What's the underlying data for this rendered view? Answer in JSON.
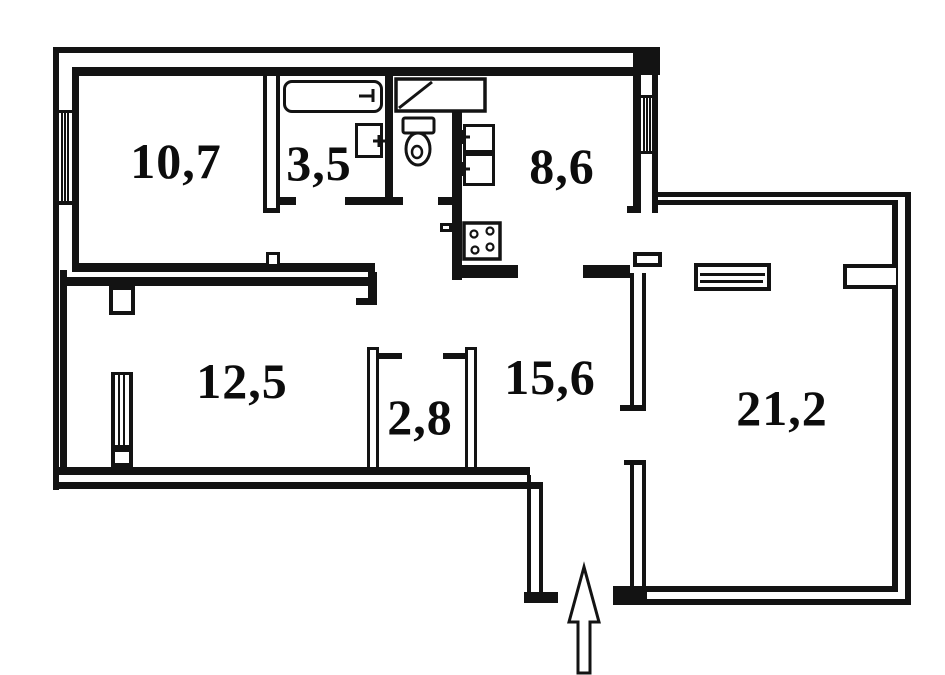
{
  "plan": {
    "kind_icon": "floor-plan",
    "colors": {
      "ink": "#131313",
      "paper": "#ffffff"
    },
    "rooms": [
      {
        "id": "room-top-left",
        "area": "10,7"
      },
      {
        "id": "room-bath",
        "area": "3,5"
      },
      {
        "id": "room-kitchen",
        "area": "8,6"
      },
      {
        "id": "room-bottom-left",
        "area": "12,5"
      },
      {
        "id": "room-closet",
        "area": "2,8"
      },
      {
        "id": "room-hall",
        "area": "15,6"
      },
      {
        "id": "room-right",
        "area": "21,2"
      }
    ],
    "fixtures": [
      "bathtub-icon",
      "wash-sink-icon",
      "toilet-icon",
      "shower-unit-icon",
      "kitchen-sink-unit-icon",
      "kitchen-sink-unit-icon",
      "stove-icon",
      "wardrobe-shelf-icon",
      "window-icon",
      "window-icon",
      "vent-window-icon",
      "entrance-arrow-icon"
    ]
  }
}
